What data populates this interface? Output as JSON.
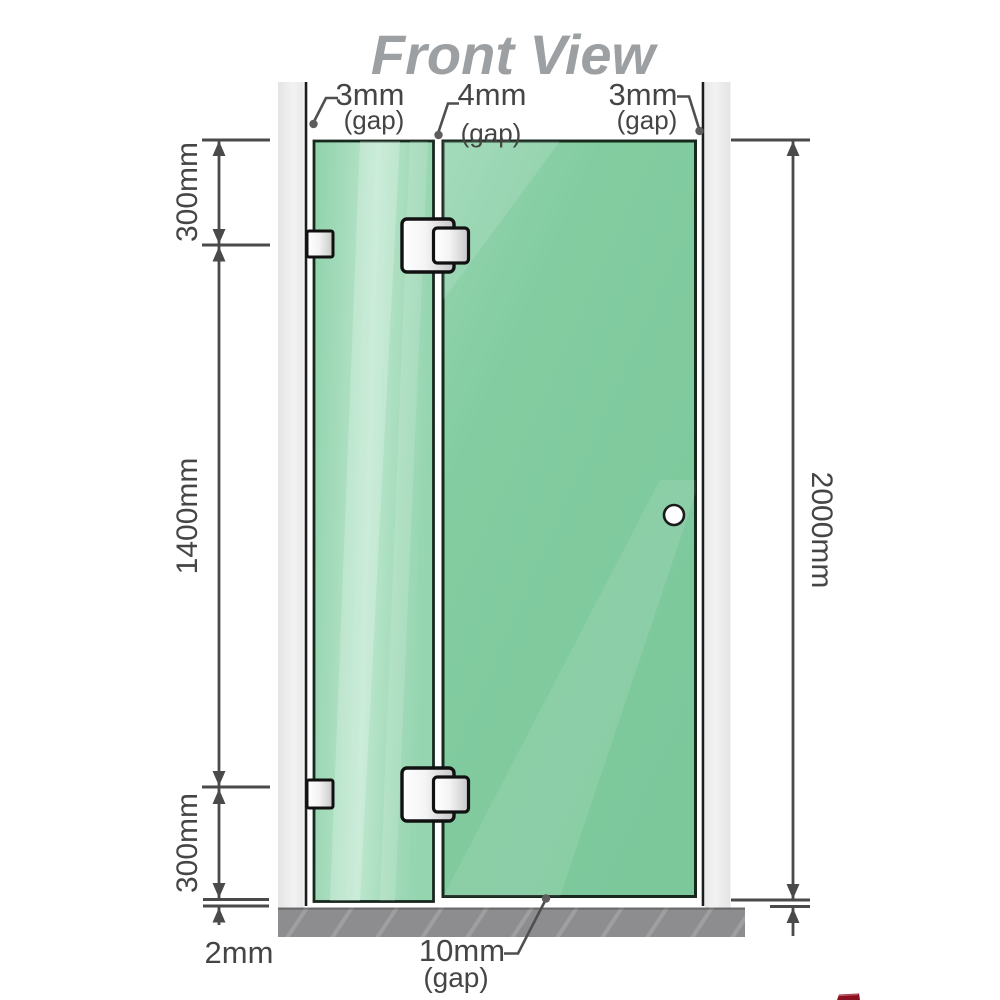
{
  "labels": {
    "title": "Front View",
    "gap_left": "3mm",
    "gap_left_note": "(gap)",
    "gap_mid": "4mm",
    "gap_mid_note": "(gap)",
    "gap_right": "3mm",
    "gap_right_note": "(gap)",
    "seg_top": "300mm",
    "seg_mid": "1400mm",
    "seg_bottom": "300mm",
    "total": "2000mm",
    "floor_gap_panel": "2mm",
    "floor_gap_door": "10mm",
    "floor_gap_door_note": "(gap)"
  },
  "colors": {
    "glass_green": "#7cc89b",
    "glass_highlight": "#bfe8d0",
    "wall_gray": "#ececec",
    "floor_gray": "#8d8d8f",
    "line_gray": "#4a4a4a",
    "title_gray": "#9ca0a2",
    "hardware_fill": "#f2f2f2",
    "hardware_border": "#111111",
    "logo_red": "#8a1220"
  }
}
